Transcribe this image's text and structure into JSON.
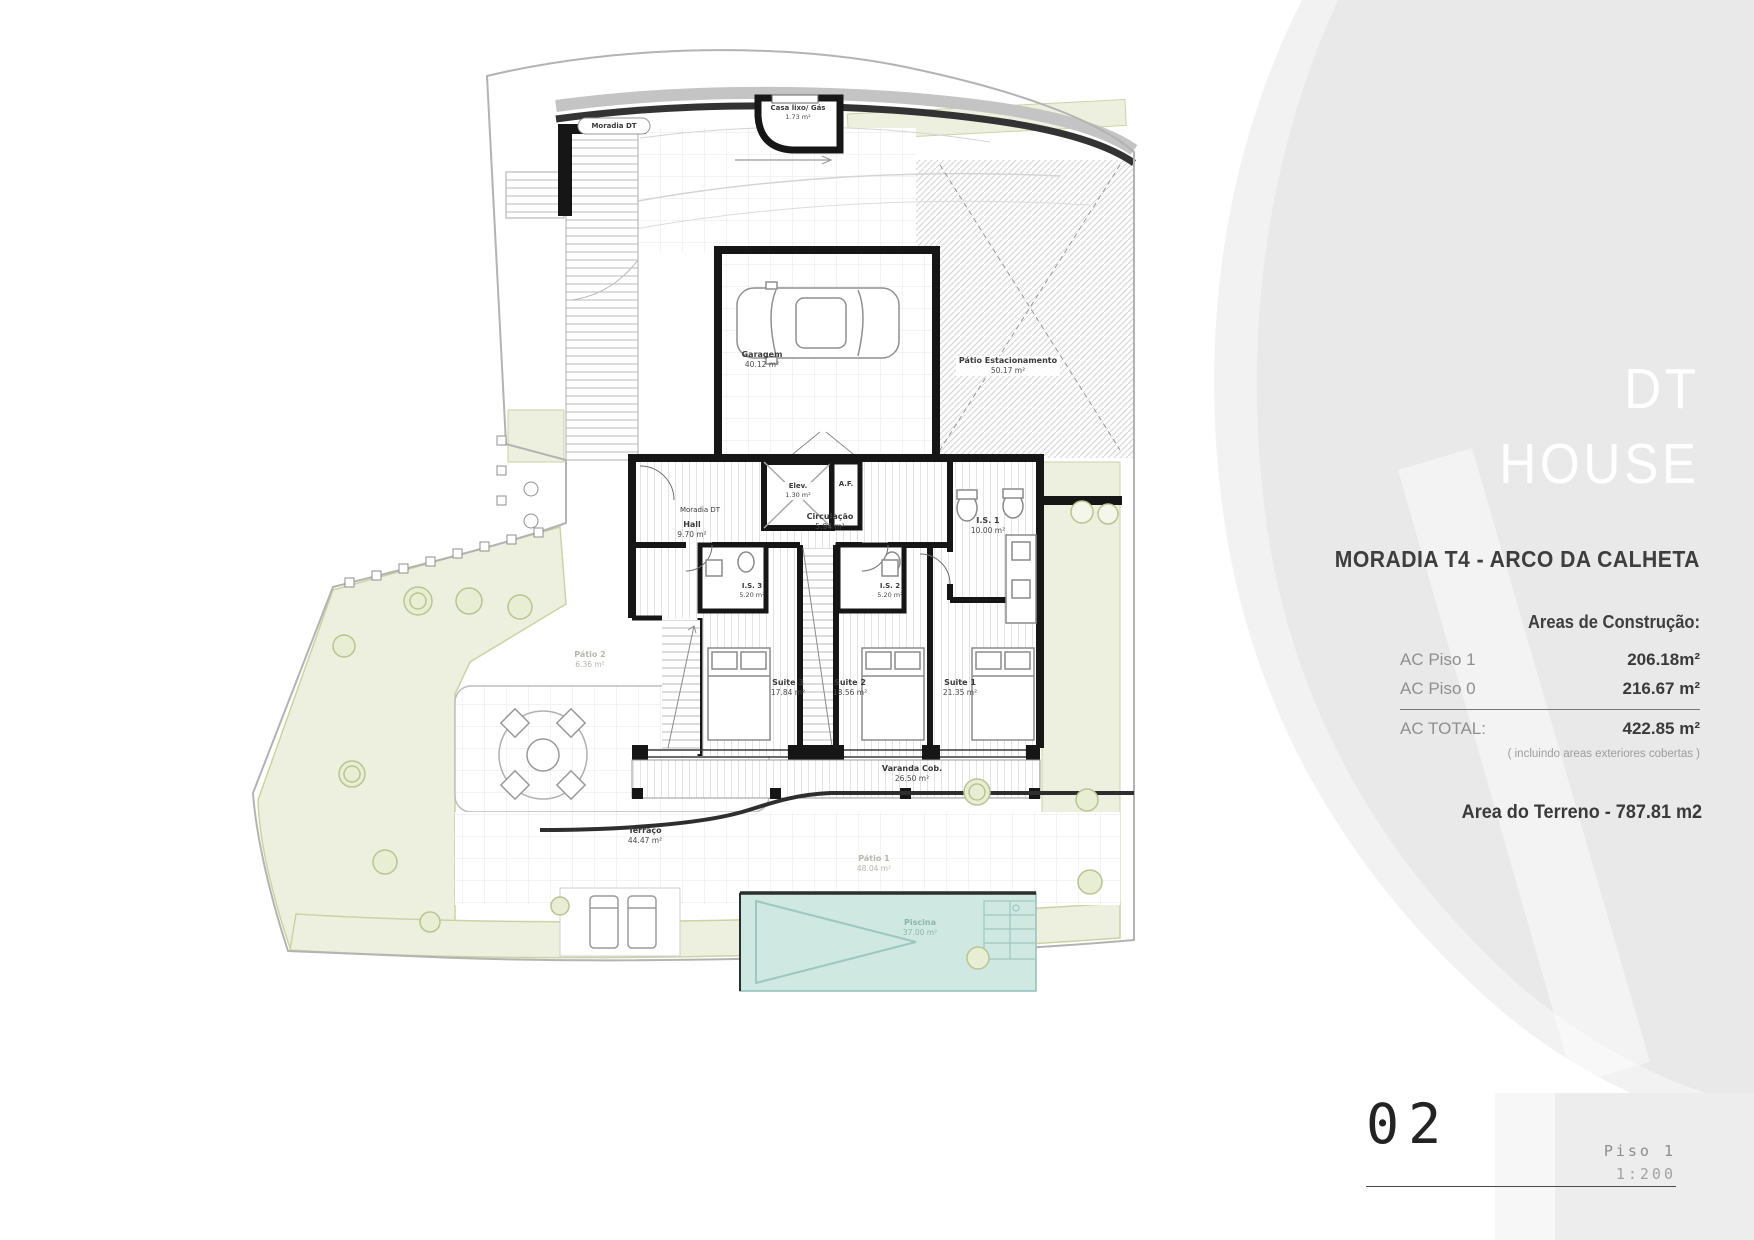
{
  "colors": {
    "sidebar_bg": "#e9e9e9",
    "sidebar_bg_light": "#f2f2f2",
    "wall": "#161616",
    "pool_fill": "#cfe8e2",
    "garden_fill": "#eef0df",
    "text_dark": "#3a3a3a",
    "text_gray": "#8f8f8f"
  },
  "sidebar": {
    "brand": {
      "line1": "DT",
      "line2": "HOUSE"
    },
    "project_title": "MORADIA T4 - ARCO DA CALHETA",
    "areas_heading": "Areas de Construção:",
    "area_rows": [
      {
        "label": "AC Piso 1",
        "value": "206.18m²"
      },
      {
        "label": "AC Piso 0",
        "value": "216.67 m²"
      }
    ],
    "total": {
      "label": "AC TOTAL:",
      "value": "422.85 m²"
    },
    "total_note": "( incluindo areas exteriores cobertas )",
    "terrain": "Area do Terreno - 787.81 m2"
  },
  "footer": {
    "sheet_number": "02",
    "floor": "Piso 1",
    "scale": "1:200"
  },
  "plan": {
    "site_label": "Moradia DT",
    "house_label": "Moradia DT",
    "rooms": {
      "casa_lixo": {
        "name": "Casa lixo/ Gás",
        "area": "1.73 m²"
      },
      "garagem": {
        "name": "Garagem",
        "area": "40.12 m²"
      },
      "patio_estacionamento": {
        "name": "Pátio Estacionamento",
        "area": "50.17 m²"
      },
      "hall": {
        "name": "Hall",
        "area": "9.70 m²"
      },
      "elevador": {
        "name": "Elev.",
        "area": "1.30 m²"
      },
      "af": {
        "name": "A.F."
      },
      "circulacao": {
        "name": "Circulação",
        "area": "5.94 m²"
      },
      "is1": {
        "name": "I.S. 1",
        "area": "10.00 m²"
      },
      "is2": {
        "name": "I.S. 2",
        "area": "5.20 m²"
      },
      "is3": {
        "name": "I.S. 3",
        "area": "5.20 m²"
      },
      "suite1": {
        "name": "Suite 1",
        "area": "21.35 m²"
      },
      "suite2": {
        "name": "Suite 2",
        "area": "18.56 m²"
      },
      "suite3": {
        "name": "Suite 3",
        "area": "17.84 m²"
      },
      "varanda": {
        "name": "Varanda Cob.",
        "area": "26.50 m²"
      },
      "terraco": {
        "name": "Terraço",
        "area": "44.47 m²"
      },
      "piscina": {
        "name": "Piscina",
        "area": "37.00 m²"
      },
      "patio1": {
        "name": "Pátio 1",
        "area": "48.04 m²"
      },
      "patio2": {
        "name": "Pátio 2",
        "area": "6.36 m²"
      }
    }
  }
}
